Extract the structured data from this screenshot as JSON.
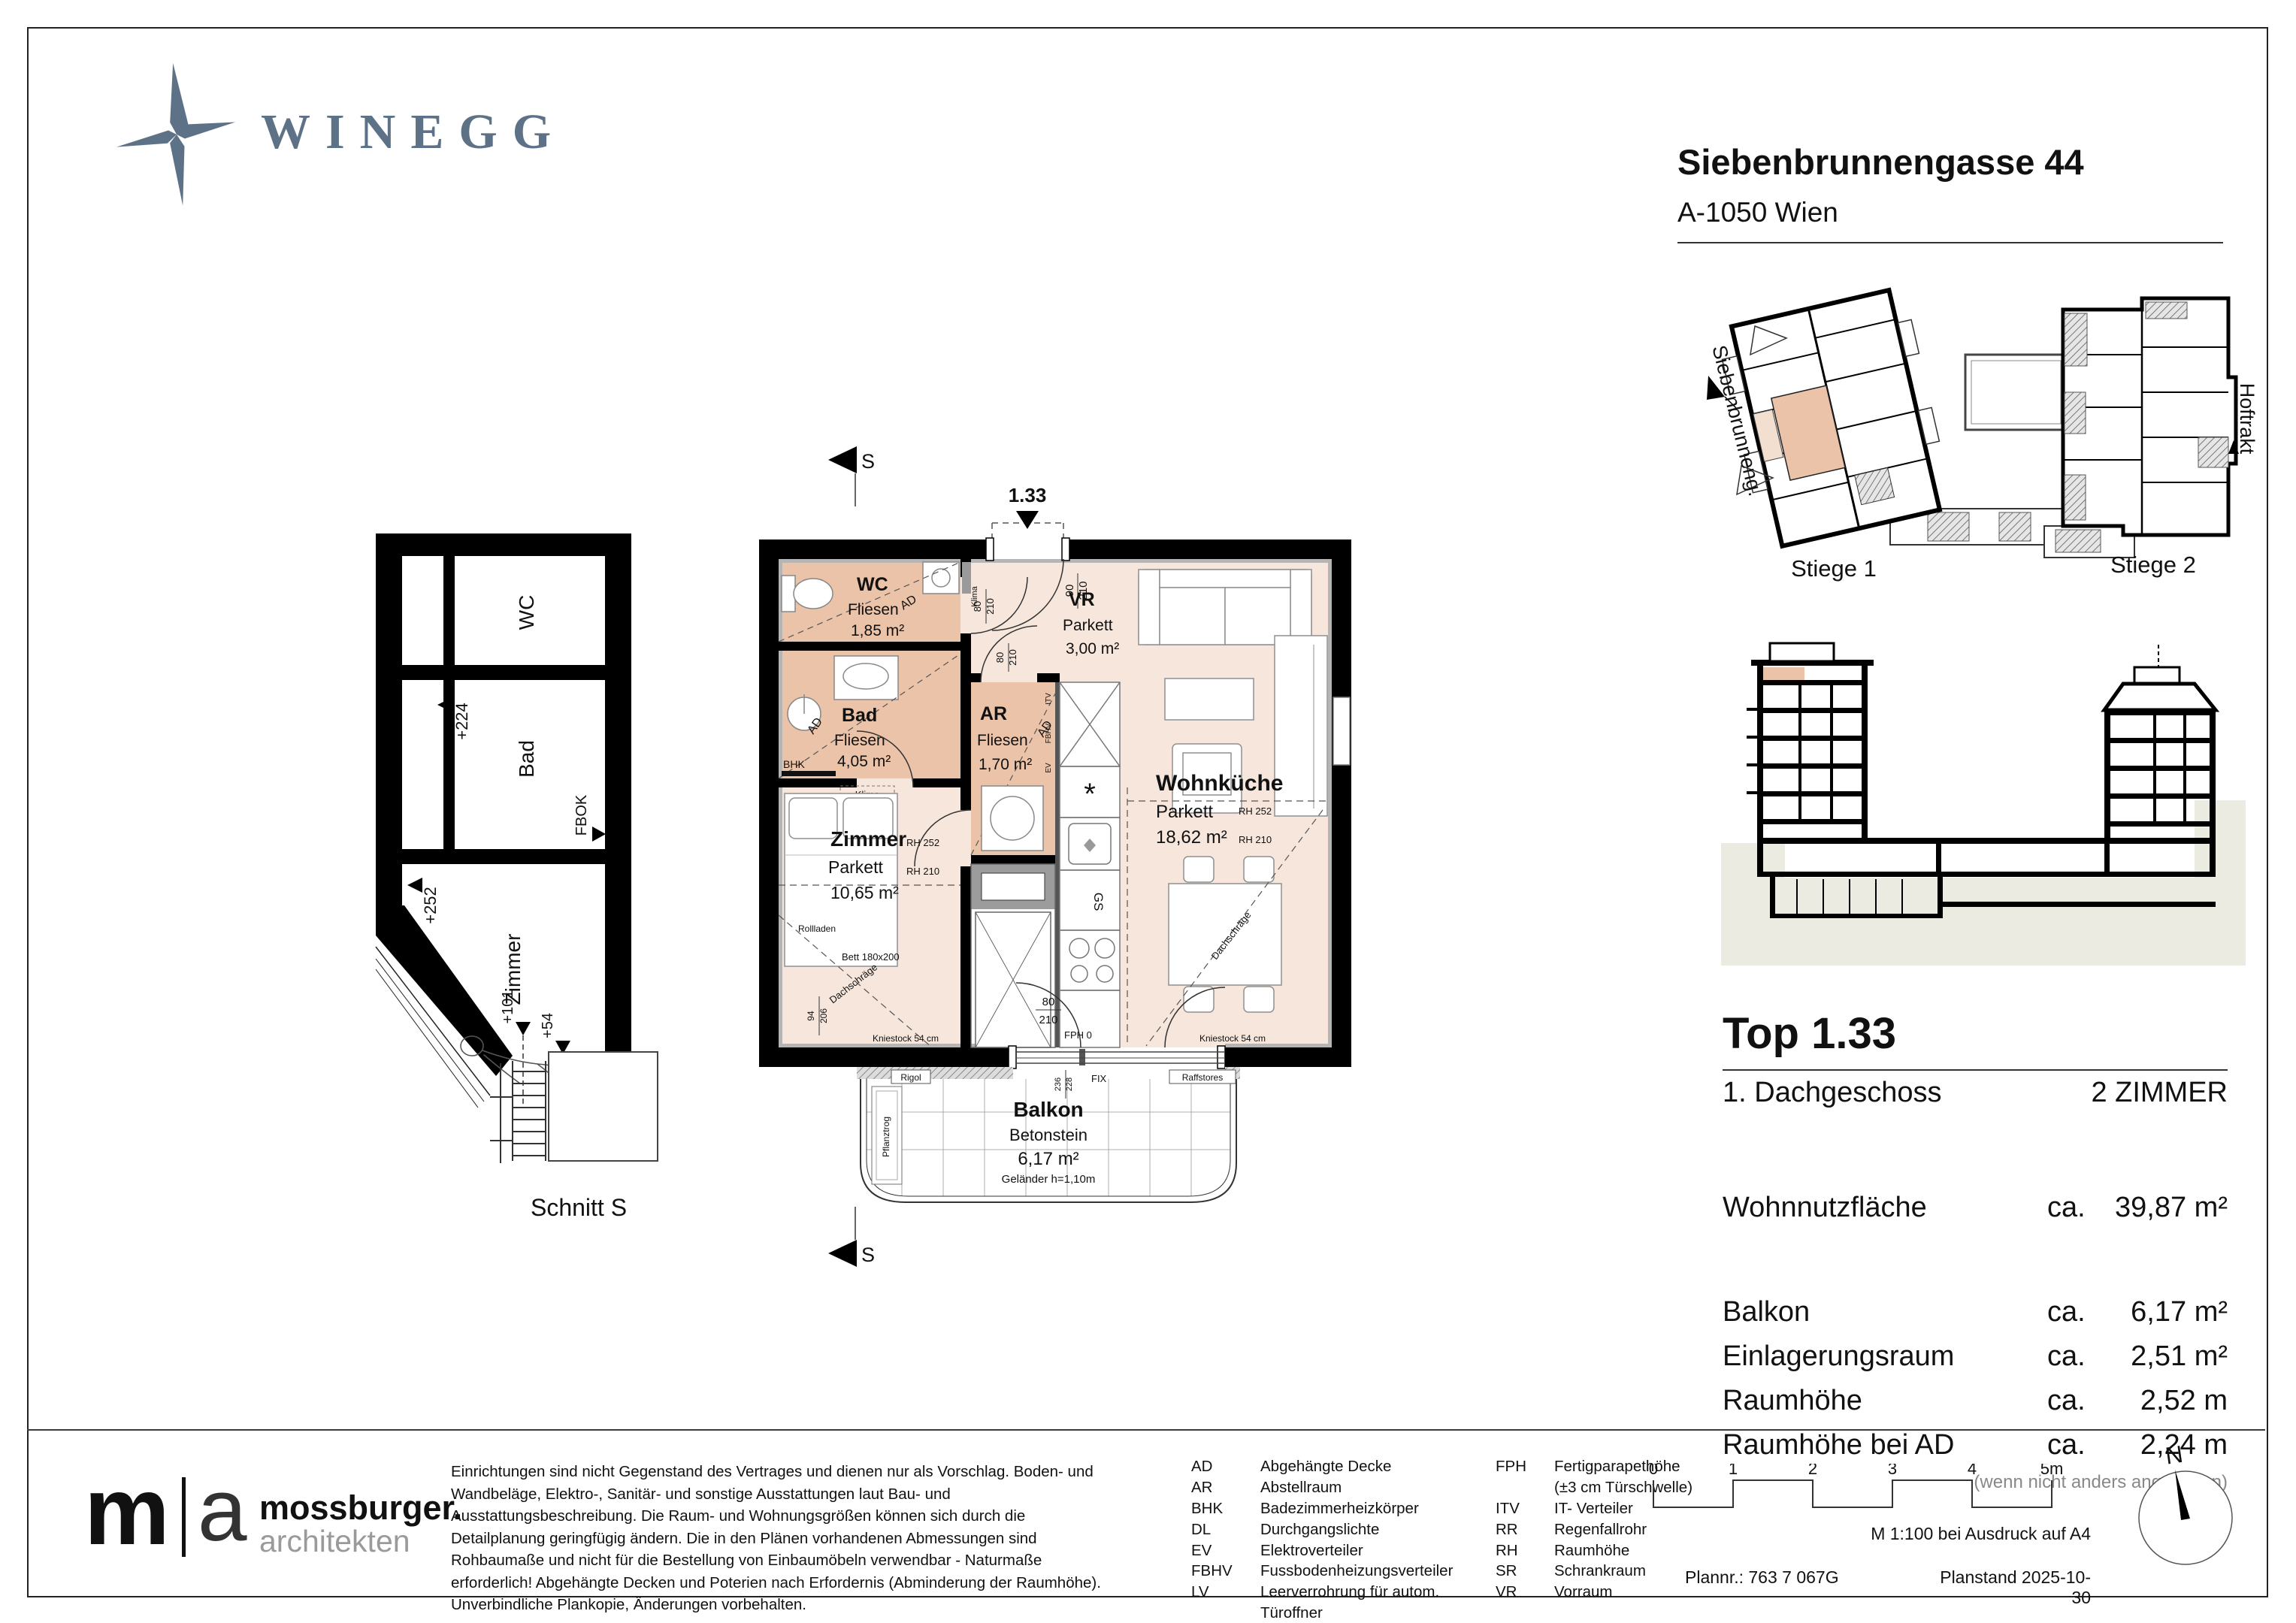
{
  "header": {
    "brand": "WINEGG",
    "title": "Siebenbrunnengasse 44",
    "subtitle": "A-1050 Wien"
  },
  "colors": {
    "brand_blue": "#5e7287",
    "room_wet": "#eac3a8",
    "room_dry": "#f6e6dc",
    "terrain": "#ebebe2"
  },
  "site_plan": {
    "street": "Siebenbrunneng.",
    "hoftrakt": "Hoftrakt",
    "stiege1": "Stiege 1",
    "stiege2": "Stiege 2"
  },
  "schnitt": {
    "label": "Schnitt S",
    "wc": "WC",
    "bad": "Bad",
    "zimmer": "Zimmer",
    "m224": "+224",
    "m252": "+252",
    "m101": "+101",
    "m54": "+54",
    "fbok": "FBOK"
  },
  "plan": {
    "unit": "1.33",
    "section_s": "S",
    "rooms": {
      "wc": {
        "name": "WC",
        "floor": "Fliesen",
        "area": "1,85 m²"
      },
      "bad": {
        "name": "Bad",
        "floor": "Fliesen",
        "area": "4,05 m²"
      },
      "ar": {
        "name": "AR",
        "floor": "Fliesen",
        "area": "1,70 m²"
      },
      "vr": {
        "name": "VR",
        "floor": "Parkett",
        "area": "3,00 m²"
      },
      "wk": {
        "name": "Wohnküche",
        "floor": "Parkett",
        "area": "18,62 m²"
      },
      "zimmer": {
        "name": "Zimmer",
        "floor": "Parkett",
        "area": "10,65 m²"
      },
      "balkon": {
        "name": "Balkon",
        "floor": "Betonstein",
        "area": "6,17 m²",
        "railing": "Geländer h=1,10m"
      }
    },
    "ann": {
      "d80": "80",
      "d210": "210",
      "d90": "90",
      "d94": "94",
      "d206": "206",
      "d236": "236",
      "d228": "228",
      "klima": "Klima",
      "bhk": "BHK",
      "ad": "AD",
      "itv": "ITV",
      "fbhv": "FBHV",
      "ev": "EV",
      "gs": "GS",
      "rh252": "RH 252",
      "rh210": "RH 210",
      "rollladen": "Rollladen",
      "bett": "Bett 180x200",
      "dachschraege": "Dachschräge",
      "kniestock": "Kniestock 54 cm",
      "fph": "FPH 0",
      "fix": "FIX",
      "rigol": "Rigol",
      "raffstores": "Raffstores",
      "pflanztrog": "Pflanztrog"
    }
  },
  "info": {
    "top": "Top 1.33",
    "floor": "1. Dachgeschoss",
    "rooms": "2 ZIMMER",
    "main": {
      "label": "Wohnnutzfläche",
      "ca": "ca.",
      "value": "39,87 m²"
    },
    "rows": [
      {
        "label": "Balkon",
        "ca": "ca.",
        "value": "6,17 m²"
      },
      {
        "label": "Einlagerungsraum",
        "ca": "ca.",
        "value": "2,51 m²"
      },
      {
        "label": "Raumhöhe",
        "ca": "ca.",
        "value": "2,52 m"
      },
      {
        "label": "Raumhöhe bei AD",
        "ca": "ca.",
        "value": "2,24 m"
      }
    ],
    "note": "(wenn nicht anders angegeben)"
  },
  "footer": {
    "logo": {
      "m": "m",
      "a": "a",
      "name": "mossburger.",
      "sub": "architekten"
    },
    "disclaimer": "Einrichtungen sind nicht Gegenstand des Vertrages und dienen nur als Vorschlag. Boden- und Wandbeläge, Elektro-, Sanitär- und sonstige Ausstattungen laut Bau- und Ausstattungsbeschreibung. Die Raum- und Wohnungsgrößen können sich durch die Detailplanung geringfügig ändern. Die in den Plänen vorhandenen Abmessungen sind Rohbaumaße und nicht für die Bestellung von Einbaumöbeln verwendbar - Naturmaße erforderlich! Abgehängte Decken und Poterien nach Erfordernis (Abminderung der Raumhöhe). Unverbindliche Plankopie, Änderungen vorbehalten.",
    "legend1": [
      {
        "abbr": "AD",
        "text": "Abgehängte Decke"
      },
      {
        "abbr": "AR",
        "text": "Abstellraum"
      },
      {
        "abbr": "BHK",
        "text": "Badezimmerheizkörper"
      },
      {
        "abbr": "DL",
        "text": "Durchgangslichte"
      },
      {
        "abbr": "EV",
        "text": "Elektroverteiler"
      },
      {
        "abbr": "FBHV",
        "text": "Fussbodenheizungsverteiler"
      },
      {
        "abbr": "LV",
        "text": "Leerverrohrung für autom. Türoffner"
      }
    ],
    "legend2": [
      {
        "abbr": "FPH",
        "text": "Fertigparapethöhe"
      },
      {
        "abbr": "",
        "text": "(±3 cm Türschwelle)"
      },
      {
        "abbr": "ITV",
        "text": "IT- Verteiler"
      },
      {
        "abbr": "RR",
        "text": "Regenfallrohr"
      },
      {
        "abbr": "RH",
        "text": "Raumhöhe"
      },
      {
        "abbr": "SR",
        "text": "Schrankraum"
      },
      {
        "abbr": "VR",
        "text": "Vorraum"
      }
    ],
    "scale": {
      "t0": "0",
      "t1": "1",
      "t2": "2",
      "t3": "3",
      "t4": "4",
      "t5": "5m",
      "note": "M 1:100 bei Ausdruck auf A4"
    },
    "plan_no": "Plannr.: 763 7 067G",
    "plan_date": "Planstand 2025-10-30",
    "north": "N"
  }
}
